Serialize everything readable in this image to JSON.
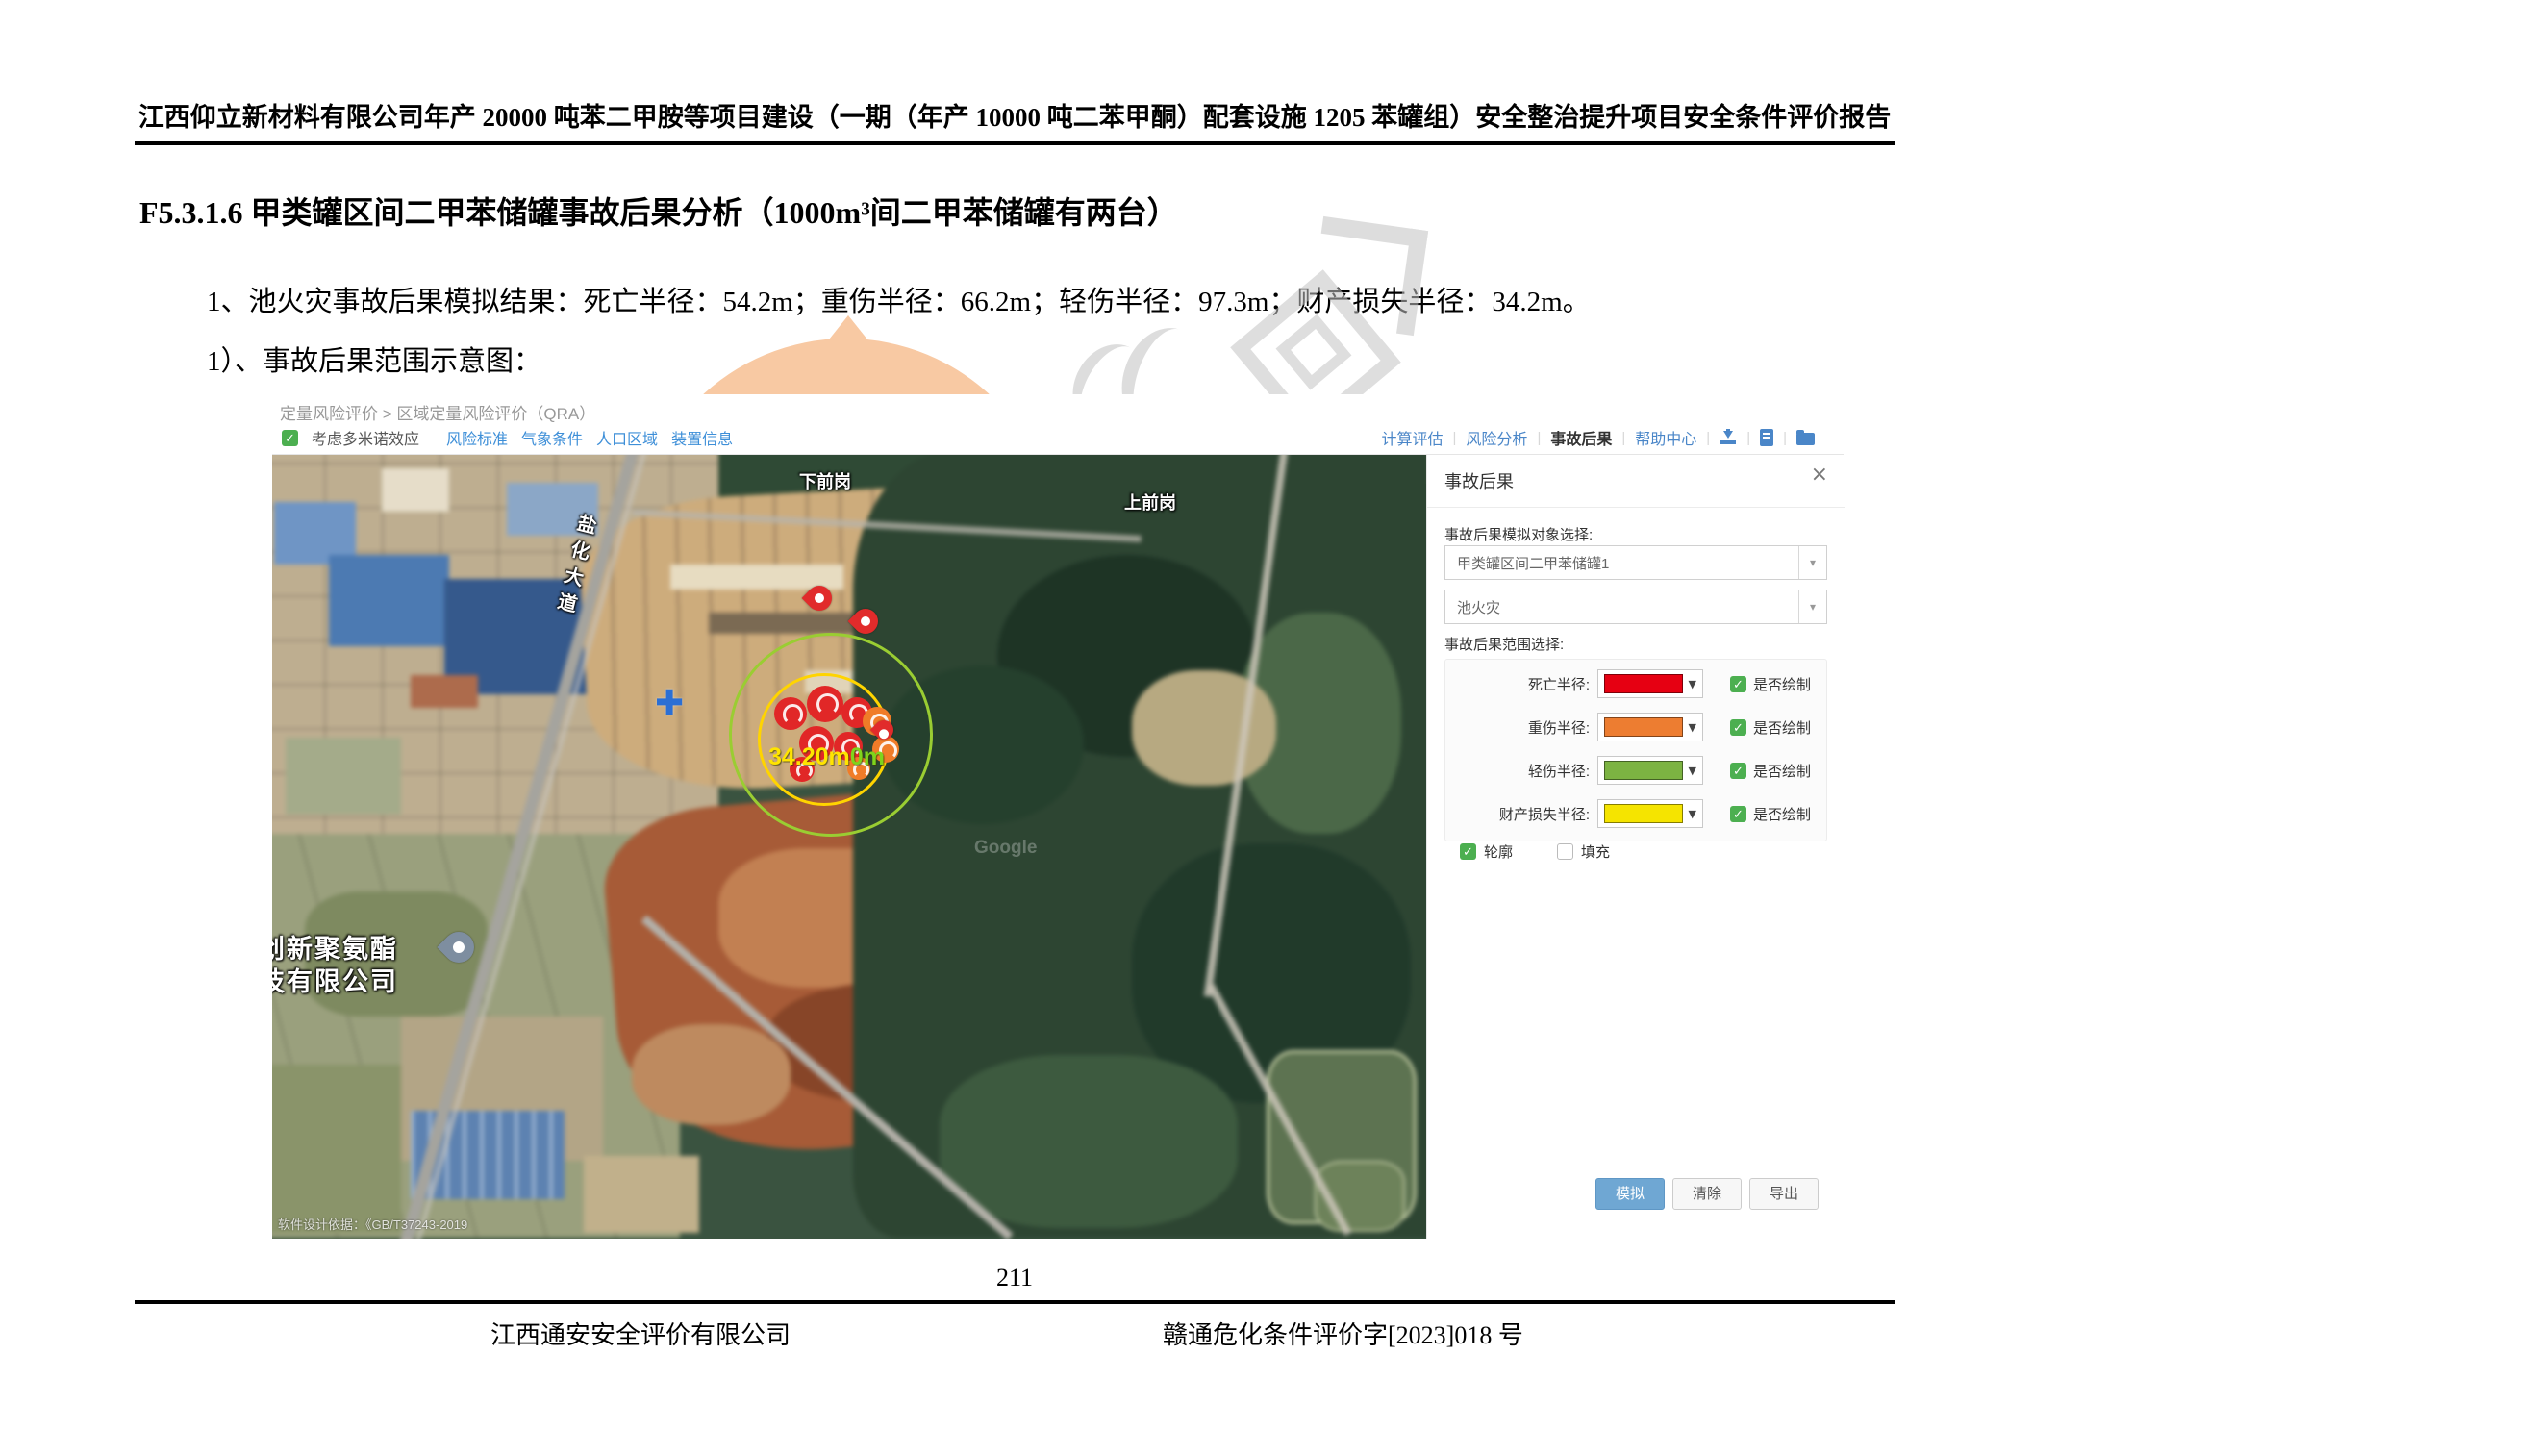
{
  "doc": {
    "header_title": "江西仰立新材料有限公司年产 20000 吨苯二甲胺等项目建设（一期（年产 10000 吨二苯甲酮）配套设施 1205 苯罐组）安全整治提升项目安全条件评价报告",
    "heading": "F5.3.1.6 甲类罐区间二甲苯储罐事故后果分析（1000m³间二甲苯储罐有两台）",
    "para1": "1、池火灾事故后果模拟结果：死亡半径：54.2m；重伤半径：66.2m；轻伤半径：97.3m；财产损失半径：34.2m。",
    "para2": "1）、事故后果范围示意图：",
    "page_number": "211",
    "footer_left": "江西通安安全评价有限公司",
    "footer_right": "赣通危化条件评价字[2023]018 号"
  },
  "app": {
    "breadcrumb": "定量风险评价 > 区域定量风险评价（QRA）",
    "domino_checkbox": {
      "checked": true,
      "label": "考虑多米诺效应"
    },
    "links": [
      {
        "label": "风险标准"
      },
      {
        "label": "气象条件"
      },
      {
        "label": "人口区域"
      },
      {
        "label": "装置信息"
      }
    ],
    "top_actions": [
      {
        "label": "计算评估",
        "active": false
      },
      {
        "label": "风险分析",
        "active": false
      },
      {
        "label": "事故后果",
        "active": true
      },
      {
        "label": "帮助中心",
        "active": false
      }
    ],
    "top_icons": [
      "download-icon",
      "file-icon",
      "folder-icon"
    ],
    "map_toolbar": [
      {
        "icon": "gear-icon",
        "glyph": "⚙",
        "label": "地图比例设置"
      },
      {
        "icon": "ruler-icon",
        "glyph": "✎",
        "label": "测距"
      },
      {
        "icon": "swap-map-icon",
        "glyph": "⟳",
        "label": "更换地图"
      }
    ],
    "map": {
      "village_top": "下前岗",
      "village_right": "上前岗",
      "road_name": "盐化大道",
      "company_line1": "创新聚氨酯",
      "company_line2": "技有限公司",
      "measure_value": "34.20m",
      "measure_value2": "0m",
      "copyright": "软件设计依据：《GB/T37243-2019",
      "imagery_credit": "Google"
    },
    "panel": {
      "title": "事故后果",
      "close_glyph": "×",
      "object_select_label": "事故后果模拟对象选择:",
      "object_value": "甲类罐区间二甲苯储罐1",
      "scenario_value": "池火灾",
      "range_select_label": "事故后果范围选择:",
      "radius_rows": [
        {
          "label": "死亡半径:",
          "color": "#e60012",
          "draw_label": "是否绘制",
          "checked": true
        },
        {
          "label": "重伤半径:",
          "color": "#ed7d31",
          "draw_label": "是否绘制",
          "checked": true
        },
        {
          "label": "轻伤半径:",
          "color": "#7cb342",
          "draw_label": "是否绘制",
          "checked": true
        },
        {
          "label": "财产损失半径:",
          "color": "#f5e400",
          "draw_label": "是否绘制",
          "checked": true
        }
      ],
      "outline_label": "轮廓",
      "fill_label": "填充",
      "outline_checked": true,
      "fill_checked": false,
      "buttons": {
        "simulate": "模拟",
        "clear": "清除",
        "export": "导出"
      }
    },
    "colors": {
      "accent_blue": "#4a86c8",
      "check_green": "#4caf50",
      "marker_red": "#e12b2b"
    }
  }
}
